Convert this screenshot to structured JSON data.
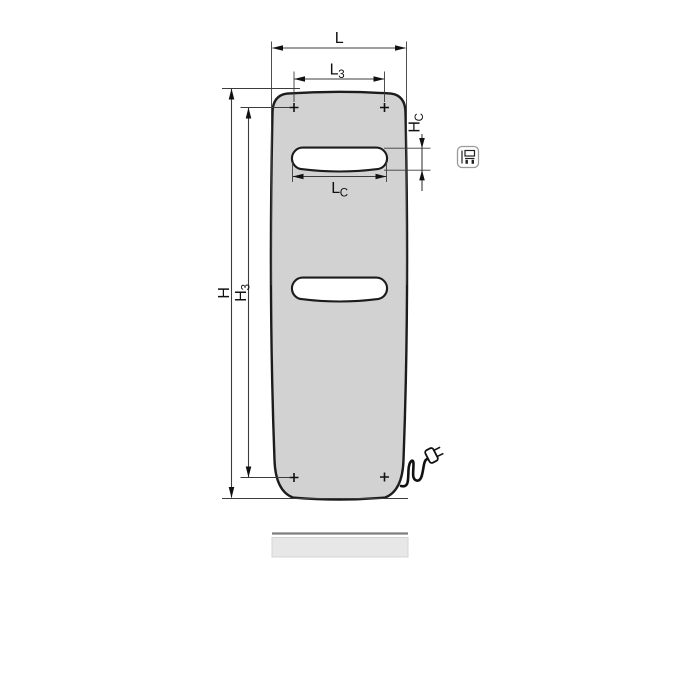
{
  "labels": {
    "L": {
      "base": "L",
      "sub": ""
    },
    "L3": {
      "base": "L",
      "sub": "3"
    },
    "LC": {
      "base": "L",
      "sub": "C"
    },
    "H": {
      "base": "H",
      "sub": ""
    },
    "H3": {
      "base": "H",
      "sub": "3"
    },
    "HC": {
      "base": "H",
      "sub": "C"
    }
  },
  "icons": {
    "badge": "towel-bar-variant-icon",
    "plug": "power-plug-icon",
    "mounting_mark": "plus-mark-icon"
  },
  "colors": {
    "background": "#ffffff",
    "panel_fill": "#d2d2d2",
    "panel_outline": "#1c1c1c",
    "slot_fill": "#ffffff",
    "dim_line": "#3c3c3c",
    "floor_fill": "#e7e7e7",
    "floor_edge": "#7f7f7f",
    "badge_border": "#9a9a9a"
  }
}
